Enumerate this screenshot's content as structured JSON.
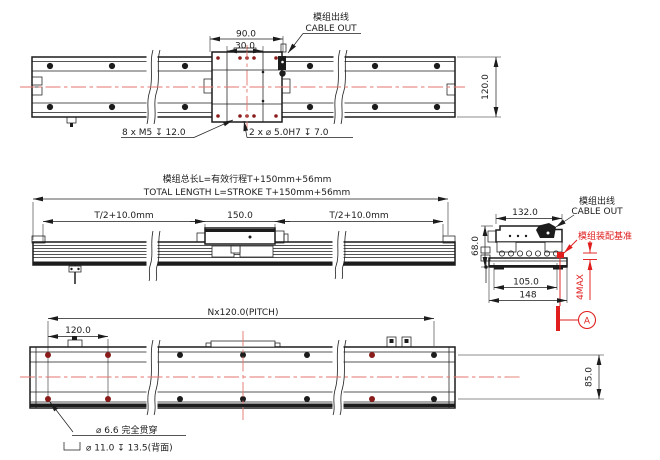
{
  "drawing": {
    "type": "engineering-drawing",
    "colors": {
      "line": "#1c1c1c",
      "centerline": "#e4766c",
      "accent": "#e01e1e",
      "hole_mark": "#8a1c1c",
      "bg": "#ffffff"
    },
    "top_view": {
      "dim_90": "90.0",
      "dim_30": "30.0",
      "dim_height": "120.0",
      "cable_label_cn": "模组出线",
      "cable_label_en": "CABLE OUT",
      "note_tap": "8 x M5 ↧ 12.0",
      "note_pin": "2 x ⌀ 5.0H7 ↧ 7.0"
    },
    "side_view": {
      "total_length_cn": "模组总长L=有效行程T+150mm+56mm",
      "total_length_en": "TOTAL LENGTH L=STROKE T+150mm+56mm",
      "dim_left": "T/2+10.0mm",
      "dim_center": "150.0",
      "dim_right": "T/2+10.0mm"
    },
    "section_view": {
      "cable_label_cn": "模组出线",
      "cable_label_en": "CABLE OUT",
      "datum_note": "模组装配基准",
      "dim_width_top": "132.0",
      "dim_height": "68.0",
      "dim_width_mid": "105.0",
      "dim_width_base": "148",
      "clearance": "4MAX",
      "datum_label": "A"
    },
    "bottom_view": {
      "dim_pitch": "Nx120.0(PITCH)",
      "dim_120": "120.0",
      "dim_85": "85.0",
      "note_through": "⌀ 6.6 完全贯穿",
      "note_cbore": "⌀ 11.0 ↧ 13.5(背面)"
    }
  }
}
